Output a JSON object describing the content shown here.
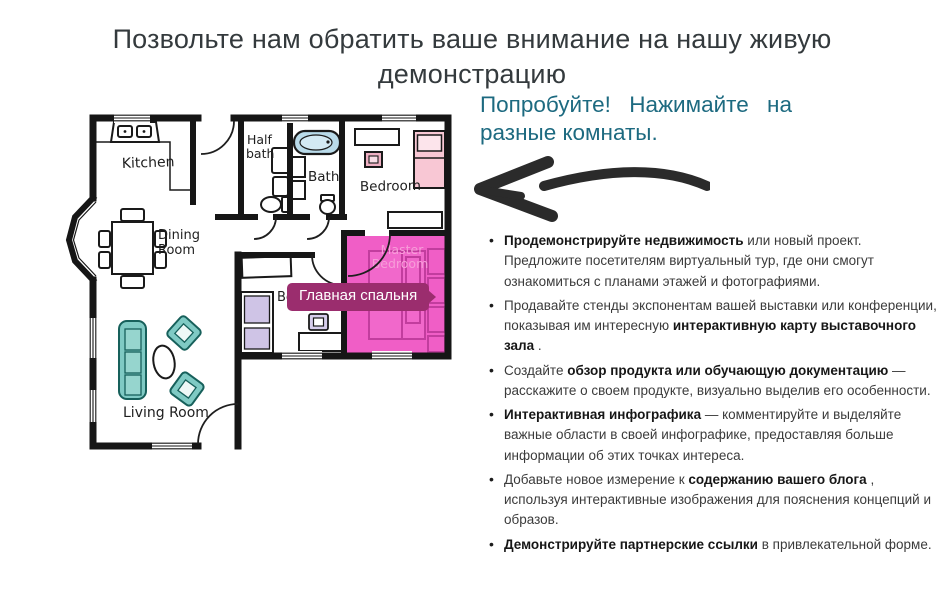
{
  "heading": {
    "title": "Позвольте нам обратить ваше внимание на нашу живую демонстрацию"
  },
  "cta": {
    "text": "Попробуйте! Нажимайте на разные комнаты."
  },
  "floorplan": {
    "tooltip": "Главная спальня",
    "rooms": {
      "kitchen": "Kitchen",
      "dining_line1": "Dining",
      "dining_line2": "Room",
      "half_bath_line1": "Half",
      "half_bath_line2": "bath",
      "bath": "Bath",
      "bedroom_top": "Bedroom",
      "bedroom_mid": "Bedroom",
      "master_line1": "Master",
      "master_line2": "Bedroom",
      "living": "Living Room"
    },
    "colors": {
      "highlight": "#f05ec6",
      "tooltip_bg": "#9b2d6e",
      "teal_furniture": "#7fcac4",
      "bed_pink": "#f8c7d4",
      "bed_lavender": "#cfc4e6",
      "tub_blue": "#b9dbea",
      "accent_text": "#1d6a80"
    }
  },
  "bullets": [
    {
      "pre": "",
      "bold": "Продемонстрируйте недвижимость",
      "post": " или новый проект. Предложите посетителям виртуальный тур, где они смогут ознакомиться с планами этажей и фотографиями."
    },
    {
      "pre": "Продавайте стенды экспонентам вашей выставки или конференции, показывая им интересную ",
      "bold": "интерактивную карту выставочного зала",
      "post": " ."
    },
    {
      "pre": "Создайте ",
      "bold": "обзор продукта или обучающую документацию",
      "post": " — расскажите о своем продукте, визуально выделив его особенности."
    },
    {
      "pre": "",
      "bold": "Интерактивная инфографика",
      "post": " — комментируйте и выделяйте важные области в своей инфографике, предоставляя больше информации об этих точках интереса."
    },
    {
      "pre": "Добавьте новое измерение к ",
      "bold": "содержанию вашего блога",
      "post": " , используя интерактивные изображения для пояснения концепций и образов."
    },
    {
      "pre": "",
      "bold": "Демонстрируйте партнерские ссылки",
      "post": " в привлекательной форме."
    }
  ]
}
